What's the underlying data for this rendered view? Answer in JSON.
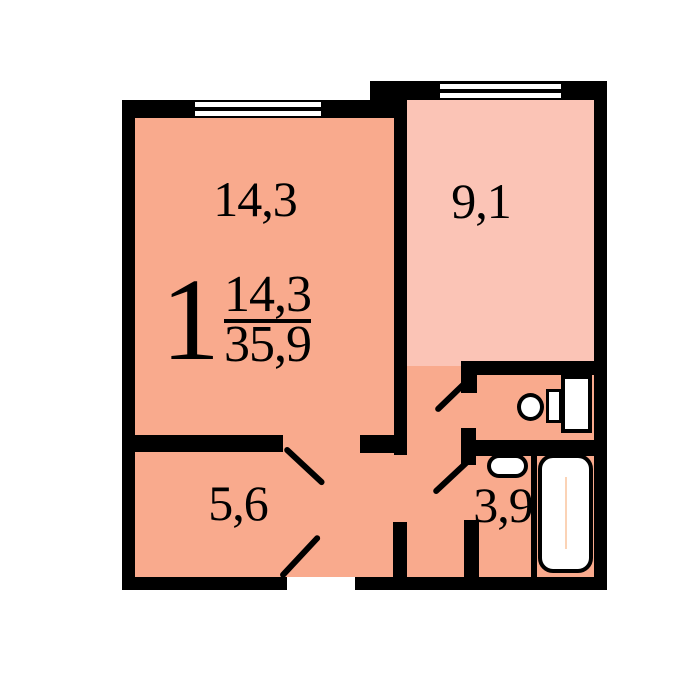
{
  "apartment": {
    "rooms_number": "1",
    "living_area": "14,3",
    "total_area": "35,9"
  },
  "rooms": {
    "living": {
      "name": "living-room",
      "label": "14,3"
    },
    "kitchen": {
      "name": "kitchen",
      "label": "9,1"
    },
    "hall": {
      "name": "hallway",
      "label": "5,6"
    },
    "bathroom": {
      "name": "bathroom",
      "label": "3,9"
    }
  },
  "fixtures": {
    "toilet": "toilet",
    "sink": "sink",
    "bathtub": "bathtub"
  },
  "features": {
    "windows": 2,
    "door_swings": 4
  },
  "colors": {
    "walls": "#000000",
    "room_fill": "#f9aa8d",
    "kitchen_fill": "#fbc4b6",
    "background": "#ffffff",
    "fixture_fill": "#ffffff",
    "tub_line": "#fbd3b6"
  }
}
